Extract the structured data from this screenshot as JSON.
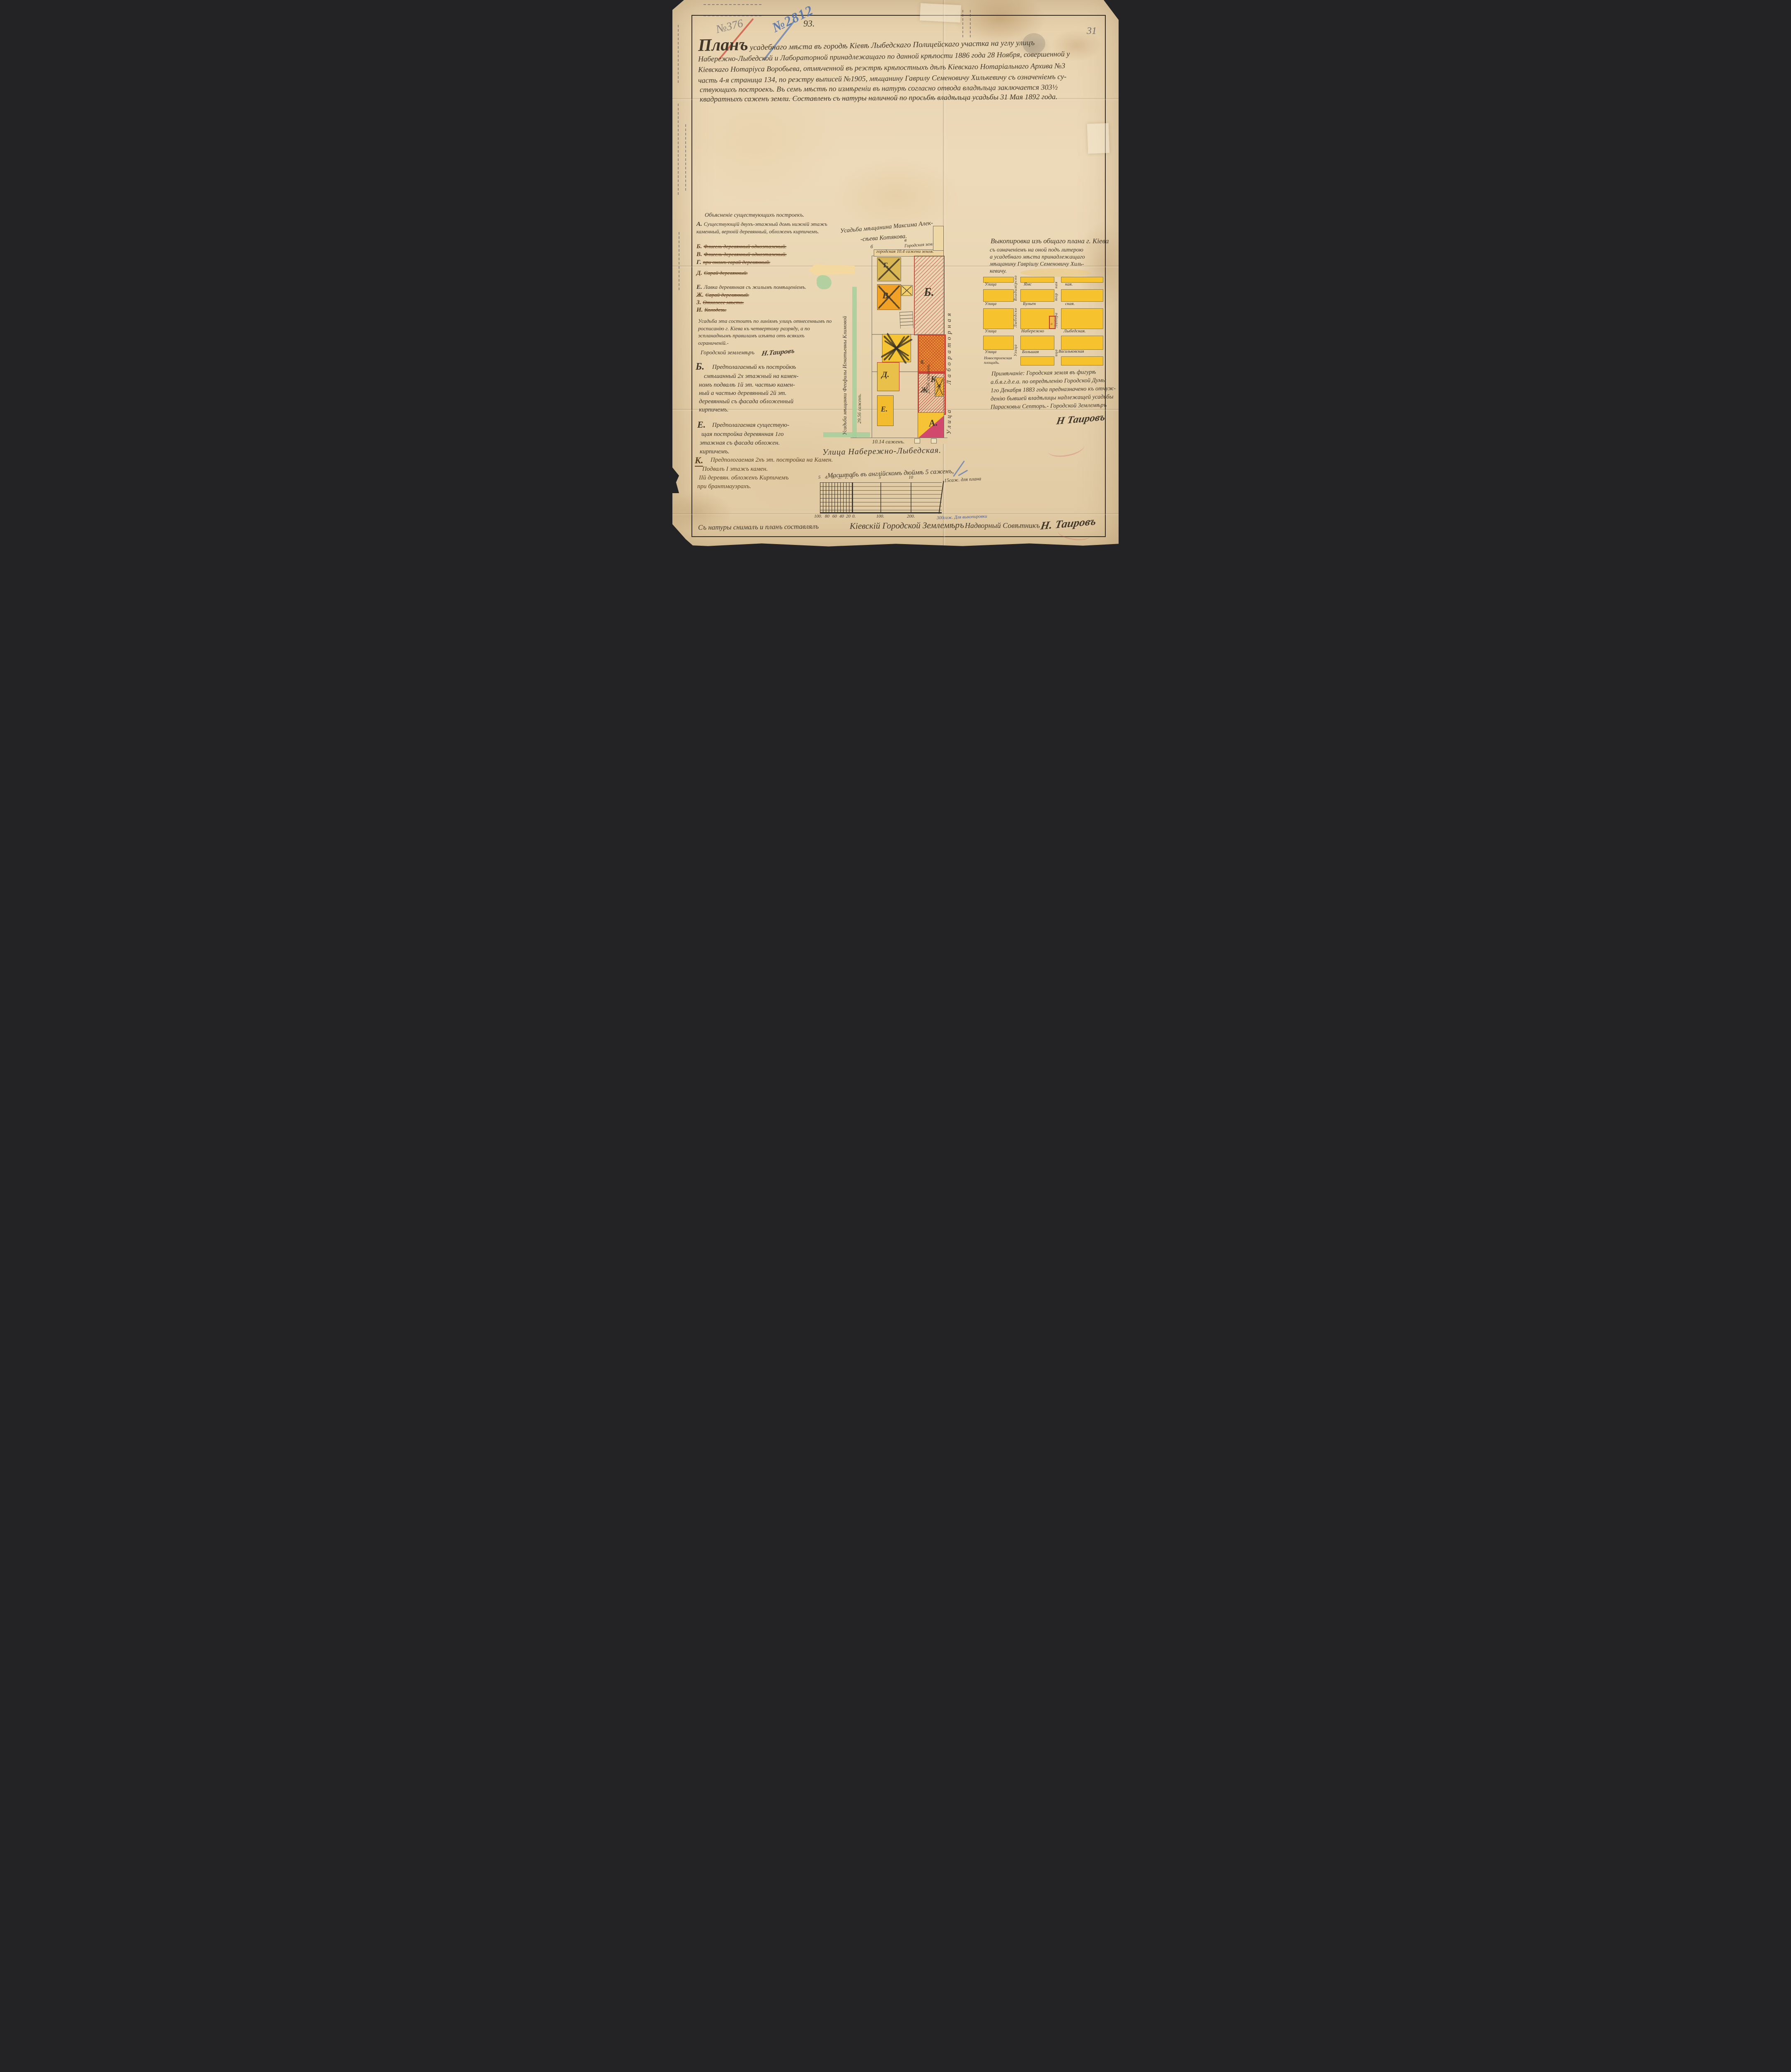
{
  "colors": {
    "paper": "#e9d6b4",
    "ink": "#42382a",
    "brown_ink": "#5d4123",
    "red": "#c0392b",
    "crimson": "#cf4568",
    "blue_pencil": "#4a6fae",
    "yellow": "#f2c12e",
    "orange": "#ee9d2b",
    "green": "#a5cf9b",
    "pencil": "#6b6458"
  },
  "corner_number": "31",
  "stamps": {
    "pencil_number": "№376",
    "blue_number": "№2812",
    "ink_number": "93."
  },
  "title": {
    "word1": "Планъ",
    "line1_rest": "усадебнаго мѣста въ городѣ Кіевѣ Лыбедскаго Полицейскаго участка на углу улицъ",
    "line2": "Набережно-Лыбедской и Лабораторной принадлежащаго по данной крѣпости 1886 года 28 Ноября, совершенной у",
    "line3": "Кіевскаго Нотаріуса Воробьева, отмѣченной въ реэстрѣ крѣпостныхъ дѣлъ Кіевскаго Нотаріальнаго Архива №3",
    "line4": "часть 4-я страница 134, по реэстру выписей №1905, мѣщанину Гаврилу Семеновичу Хилькевичу съ означеніемъ су-",
    "line5": "ствующихъ построекъ. Въ семъ мѣстѣ по измѣреніи въ натурѣ согласно отвода владѣльца заключается 303½",
    "line6": "квадратныхъ саженъ земли. Составленъ съ натуры наличной по просьбѣ владѣльца усадьбы 31 Мая 1892 года."
  },
  "legend": {
    "header": "Объясненіе существующихъ построекъ.",
    "items": [
      {
        "letter": "А.",
        "text": "Существующій двухъ-этажный домъ нижній этажъ каменный, верхній деревянный, обложенъ кирпичемъ.",
        "struck": false
      },
      {
        "letter": "Б.",
        "text": "Флигель деревянный одноэтажный.",
        "struck": true
      },
      {
        "letter": "В.",
        "text": "Флигель деревянный одноэтажный.",
        "struck": true
      },
      {
        "letter": "Г.",
        "text": "при ономъ сарай деревянный.",
        "struck": true
      },
      {
        "letter": "Д.",
        "text": "Сарай деревянный.",
        "struck": true
      },
      {
        "letter": "Е.",
        "text": "Лавка деревянная съ жилымъ помѣщеніемъ.",
        "struck": false
      },
      {
        "letter": "Ж.",
        "text": "Сарай деревянный.",
        "struck": true
      },
      {
        "letter": "З.",
        "text": "Отхожее мѣсто.",
        "struck": true
      },
      {
        "letter": "И.",
        "text": "Колодезь.",
        "struck": true
      }
    ],
    "paragraph": "Усадьба эта состоитъ по линіямъ улицъ отнесеннымъ по росписанію г. Кіева къ четвертому разряду, а по эспланаднымъ правиламъ изъята отъ всякихъ ограниченій.-",
    "signer_title": "Городской землемѣръ",
    "signer_signature": "Н.Таировъ"
  },
  "section_b": {
    "letter": "Б.",
    "lines": [
      "Предполагаемый къ постройкѣ",
      "смѣшанный 2х этажный на камен-",
      "номъ подвалѣ 1й эт. частью камен-",
      "ный а частью деревянный 2й эт.",
      "деревянный съ фасада обложенный",
      "кирпичемъ."
    ]
  },
  "section_e": {
    "letter": "Е.",
    "lines": [
      "Предполагаемая существую-",
      "щая постройка деревянная 1го",
      "этажная съ фасада обложен.",
      "кирпичемъ."
    ]
  },
  "section_k": {
    "letter": "К.",
    "lines": [
      "Предпологаемая 2хъ эт. постройка на Камен.",
      "Подвалъ I этажъ камен.",
      "IIй деревян. обложенъ Кирпичемъ",
      "при брантмауэрахъ."
    ]
  },
  "plan": {
    "neighbor_top_line1": "Усадьба мѣщанина Максима Алек-",
    "neighbor_top_line2": "-сѣева Котякова.",
    "city_land": "Городская земля.",
    "city_strip": "городская 10.4 сажени земля.",
    "corner_b": "б",
    "corner_v": "в",
    "corner_g": "г",
    "owner_left": "Усадьба мѣщанки Феофилы Игнатьевны Климовой",
    "dim_left": "29.56 саженъ.",
    "dim_right": "29.56 саженъ.",
    "dim_bottom": "10.14 саженъ.",
    "street_bottom": "Улица Набережно-Лыбедская.",
    "street_right_word": "Улица",
    "street_right_name": "Лабораторная",
    "buildings": {
      "g": "Г.",
      "v": "В.",
      "b": "Б.",
      "d": "Д.",
      "e": "Е.",
      "b_small": "б.",
      "k": "К.",
      "zh": "Ж",
      "zh2": "Ж",
      "a": "А."
    }
  },
  "vykopirovka": {
    "lines": [
      "Выкопировка изъ общаго плана г. Кіева",
      "съ означеніемъ на оной подъ литерою",
      "а усадебнаго мѣста принадлежащаго",
      "мѣщанину Гавріилу Семеновичу Хиль-",
      "кевичу."
    ]
  },
  "minimap": {
    "streets_h": [
      {
        "w1": "Улица",
        "w2": "Ямс",
        "w3": "кая."
      },
      {
        "w1": "Улица",
        "w2": "Бульен",
        "w3": "ская."
      },
      {
        "w1": "Улица",
        "w2": "Набережно",
        "w3": "Лыбедская."
      },
      {
        "w1": "Улица",
        "w2": "Большая",
        "w3": "Васильковская"
      }
    ],
    "v1_top": "Владимірско",
    "v1_mid": "Лыбедско",
    "v1_bottom": "Улица",
    "v2_seg1": "ная",
    "v2_seg2": "тор",
    "v2_seg3": "Лабора",
    "v2_seg4": "ица",
    "plot_letter": "а",
    "square": "Новостроенская площадь."
  },
  "note": {
    "lines": [
      "Примѣчаніе: Городская земля въ фигурѣ",
      "а.б.в.г.д.е.а. по опредѣленію Городской Думы",
      "1го Декабря 1883 года предназначено къ отчуж-",
      "денію бывшей владѣлицы надлежащей усадьбы",
      "Парасковьи Септоръ.- Городской Землемѣръ"
    ],
    "signature": "Н Таировъ"
  },
  "scale": {
    "caption": "Масштабъ въ англійскомъ дюймѣ 5 саженъ,",
    "plan_ticks": [
      "5",
      "4.",
      "3.",
      "2.",
      "1.",
      "0",
      "5",
      "10"
    ],
    "plan_right_label": "15саж. для плана",
    "map_ticks": [
      "100.",
      "80",
      "60",
      "40",
      "20",
      "0.",
      "100.",
      "200."
    ],
    "map_right_label": "300саж. Для выкопировки"
  },
  "bottom": {
    "t1": "Съ натуры снималъ и планъ составлялъ",
    "t2": "Кіевскій Городской Землемѣръ",
    "t3": "Надворный Совѣтникъ",
    "signature": "Н. Таировъ"
  }
}
